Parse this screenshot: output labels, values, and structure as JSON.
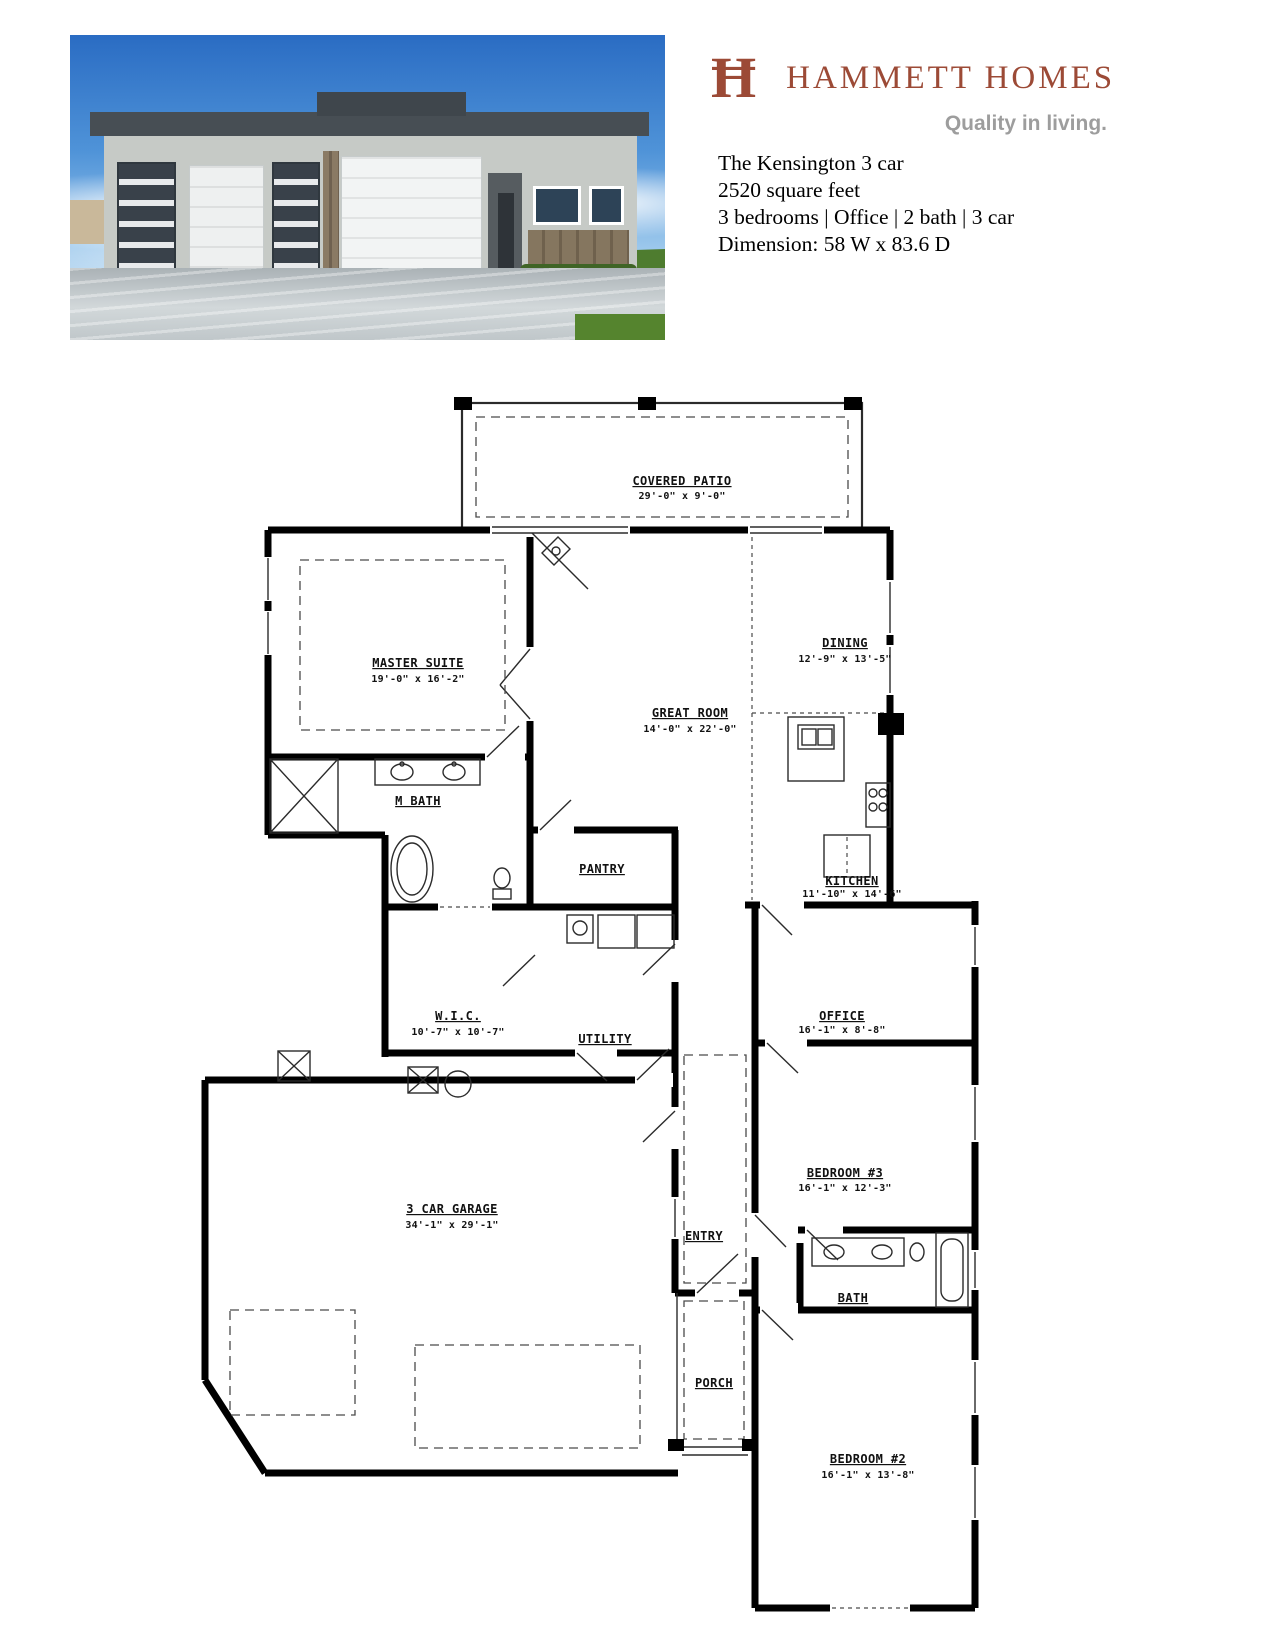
{
  "header": {
    "logo": {
      "monogram": "Ħ",
      "brand_name": "HAMMETT HOMES",
      "tagline": "Quality in living.",
      "brand_color": "#9c4a36",
      "tagline_color": "#9d9d9d"
    },
    "property": {
      "name": "The Kensington 3 car",
      "square_feet": "2520 square feet",
      "features": "3 bedrooms | Office | 2 bath | 3 car",
      "dimension": "Dimension: 58 W x 83.6 D"
    }
  },
  "floorplan": {
    "rooms": {
      "covered_patio": {
        "name": "COVERED PATIO",
        "dims": "29'-0\" x 9'-0\""
      },
      "master_suite": {
        "name": "MASTER SUITE",
        "dims": "19'-0\" x 16'-2\""
      },
      "dining": {
        "name": "DINING",
        "dims": "12'-9\" x 13'-5\""
      },
      "great_room": {
        "name": "GREAT ROOM",
        "dims": "14'-0\" x 22'-0\""
      },
      "m_bath": {
        "name": "M BATH"
      },
      "pantry": {
        "name": "PANTRY"
      },
      "kitchen": {
        "name": "KITCHEN",
        "dims": "11'-10\" x 14'-6\""
      },
      "wic": {
        "name": "W.I.C.",
        "dims": "10'-7\" x 10'-7\""
      },
      "utility": {
        "name": "UTILITY"
      },
      "office": {
        "name": "OFFICE",
        "dims": "16'-1\" x 8'-8\""
      },
      "bedroom3": {
        "name": "BEDROOM #3",
        "dims": "16'-1\" x 12'-3\""
      },
      "entry": {
        "name": "ENTRY"
      },
      "garage": {
        "name": "3 CAR GARAGE",
        "dims": "34'-1\" x 29'-1\""
      },
      "bath": {
        "name": "BATH"
      },
      "porch": {
        "name": "PORCH"
      },
      "bedroom2": {
        "name": "BEDROOM #2",
        "dims": "16'-1\" x 13'-8\""
      }
    }
  }
}
